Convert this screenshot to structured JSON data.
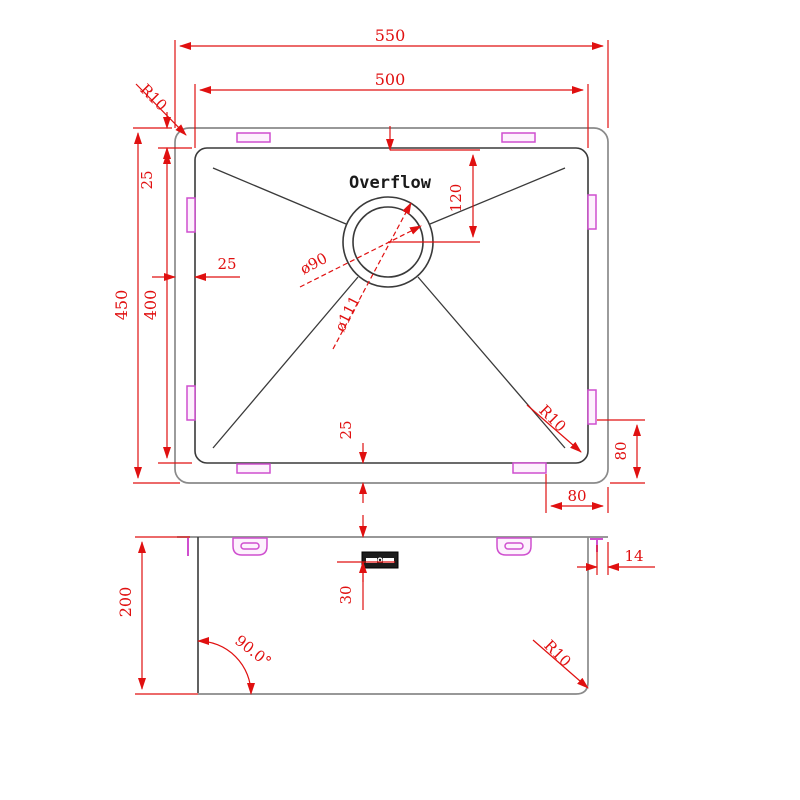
{
  "drawing": {
    "kind": "sink-technical-drawing",
    "labels": {
      "overflow": "Overflow"
    },
    "top_view": {
      "dims": {
        "overall_width": "550",
        "bowl_width": "500",
        "overall_depth": "450",
        "bowl_depth": "400",
        "rim_top": "25",
        "rim_left": "25",
        "rim_bottom": "25",
        "drain_from_top": "120",
        "drain_diameter": "ø90",
        "flange_diameter": "ø111",
        "clip_from_bottom": "80",
        "clip_from_right": "80",
        "corner_radius_outer": "R10",
        "corner_radius_inner": "R10"
      }
    },
    "side_view": {
      "dims": {
        "height": "200",
        "overflow_from_top": "30",
        "rim_lip": "14",
        "wall_angle": "90.0°",
        "corner_radius": "R10"
      }
    },
    "colors": {
      "dimension_red": "#e01010",
      "clip_magenta": "#cf4fcf",
      "outline_gray": "#8a8a8a",
      "outline_dark": "#3a3a3a"
    }
  }
}
